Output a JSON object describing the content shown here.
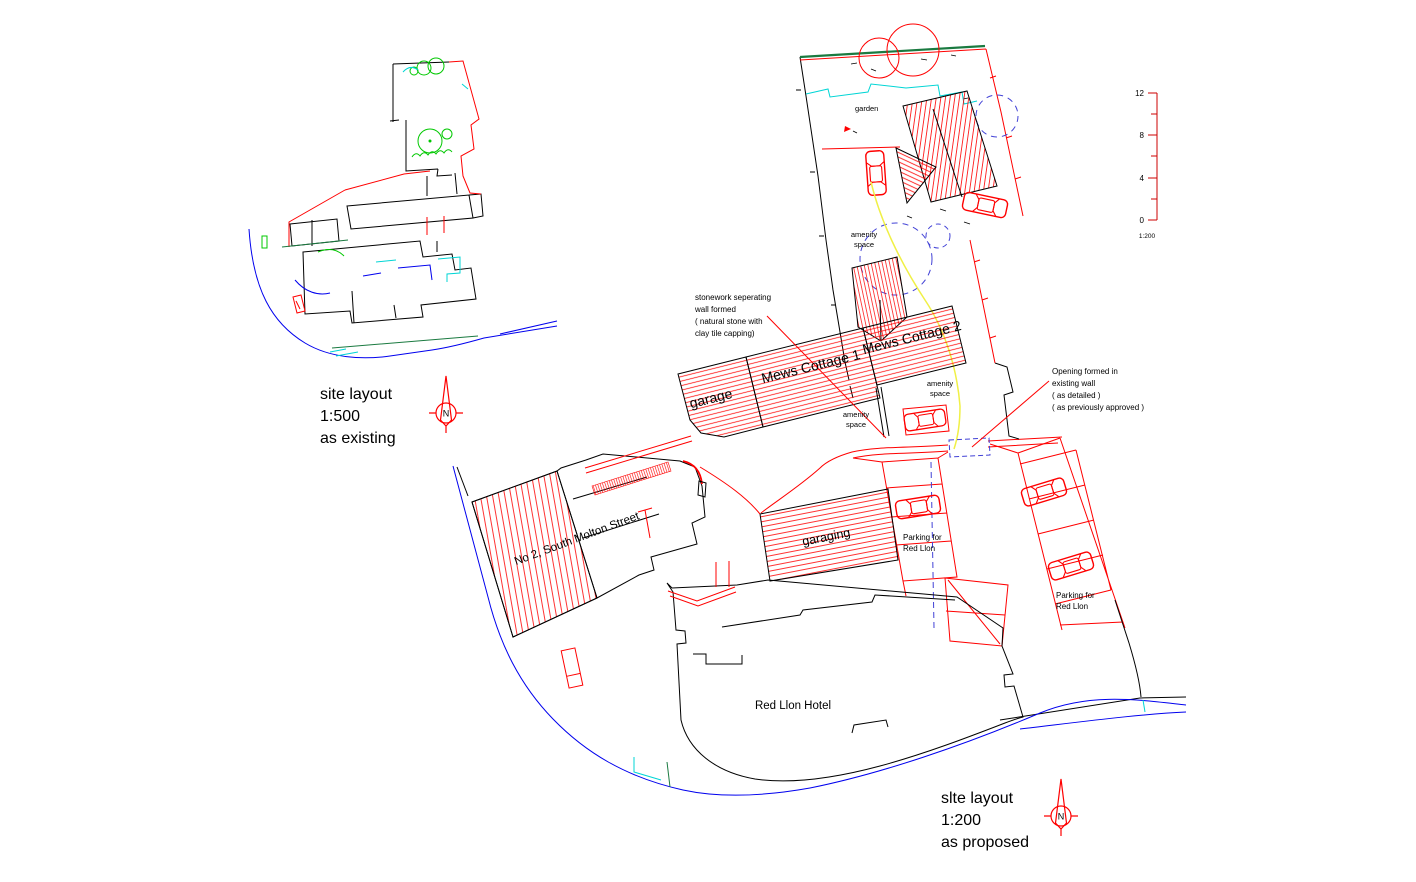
{
  "drawing": {
    "titles": {
      "existing": [
        "site layout",
        "1:500",
        "as existing"
      ],
      "proposed": [
        "slte layout",
        "1:200",
        "as proposed"
      ]
    },
    "labels": {
      "garden": "garden",
      "amenity": [
        "amenity",
        "space"
      ],
      "garage": "garage",
      "mews_cottage_1": "Mews Cottage 1",
      "mews_cottage_2": "Mews Cottage 2",
      "no2_south_molton": "No 2, South Molton Street",
      "garaging": "garaging",
      "red_lion_hotel": "Red Llon Hotel",
      "parking": [
        "Parking for",
        "Red Llon"
      ]
    },
    "annotations": {
      "stonework": [
        "stonework seperating",
        "wall formed",
        "( natural stone with",
        "clay tile capping)"
      ],
      "opening": [
        "Opening formed in",
        "existing wall",
        "( as detailed )",
        "( as previously approved )"
      ]
    },
    "scale_bar": {
      "ticks": [
        "12",
        "8",
        "4",
        "0"
      ],
      "ratio": "1:200"
    },
    "north_letter": "N",
    "colors": {
      "line_black": "#000000",
      "boundary_red": "#ff0000",
      "road_blue": "#0000ee",
      "detail_cyan": "#00d5d5",
      "tree_green": "#00c800",
      "wall_green": "#1a7a40",
      "amenity_yellow": "#f0f046",
      "proposed_tree_blue": "#4242d6"
    }
  }
}
